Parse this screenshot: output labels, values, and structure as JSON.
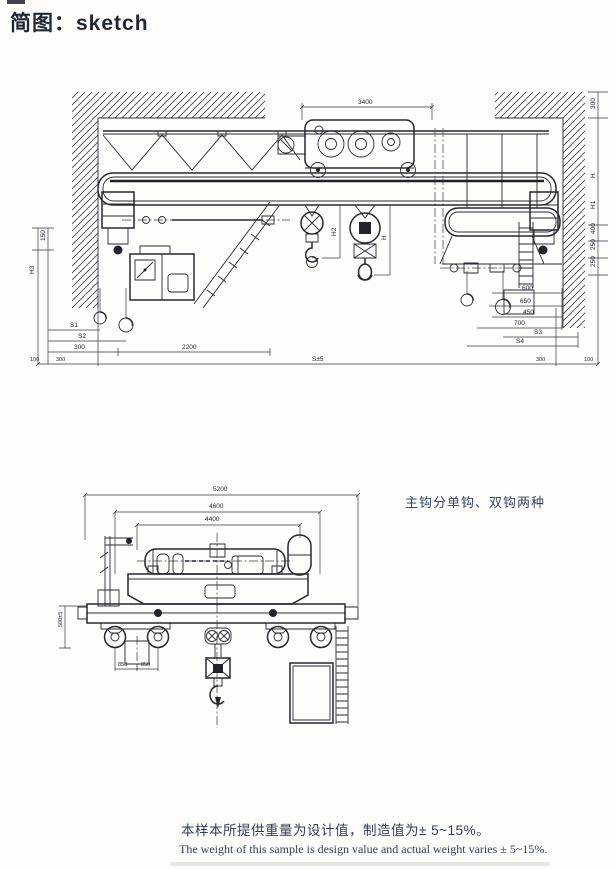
{
  "title": "简图：sketch",
  "notes": {
    "hook_type_note": "主钩分单钩、双钩两种",
    "weight_note_zh": "本样本所提供重量为设计值，制造值为± 5~15%。",
    "weight_note_en": "The weight of this sample is design value and actual weight varies ± 5~15%."
  },
  "colors": {
    "ink": "#2a2a33",
    "text": "#313c55"
  },
  "drawing1": {
    "description": "double-girder overhead crane, front elevation between hatched walls",
    "dims": {
      "trolley_wheelbase": "3400",
      "span": "S±5",
      "top_clearance": "300",
      "h": "H",
      "h1": "H1",
      "h2": "H2",
      "h3": "H3",
      "left_small": "150",
      "s1": "S1",
      "s2": "S2",
      "s3": "S3",
      "s4": "S4",
      "bottom_left_a": "300",
      "bottom_left_b": "2200",
      "edge_l1": "100",
      "edge_l2": "300",
      "edge_r1": "300",
      "edge_r2": "100",
      "right_col_a": "400",
      "right_col_b": "250",
      "right_col_c": "250",
      "right_stack_a": "600",
      "right_stack_b": "650",
      "right_stack_c": "450",
      "right_stack_d": "700"
    }
  },
  "drawing2": {
    "description": "crane trolley end view on bridge end carriage",
    "dims": {
      "overall": "5200",
      "mid": "4600",
      "inner": "4400",
      "wheel_a": "850",
      "wheel_b": "850",
      "height": "500±5"
    }
  }
}
